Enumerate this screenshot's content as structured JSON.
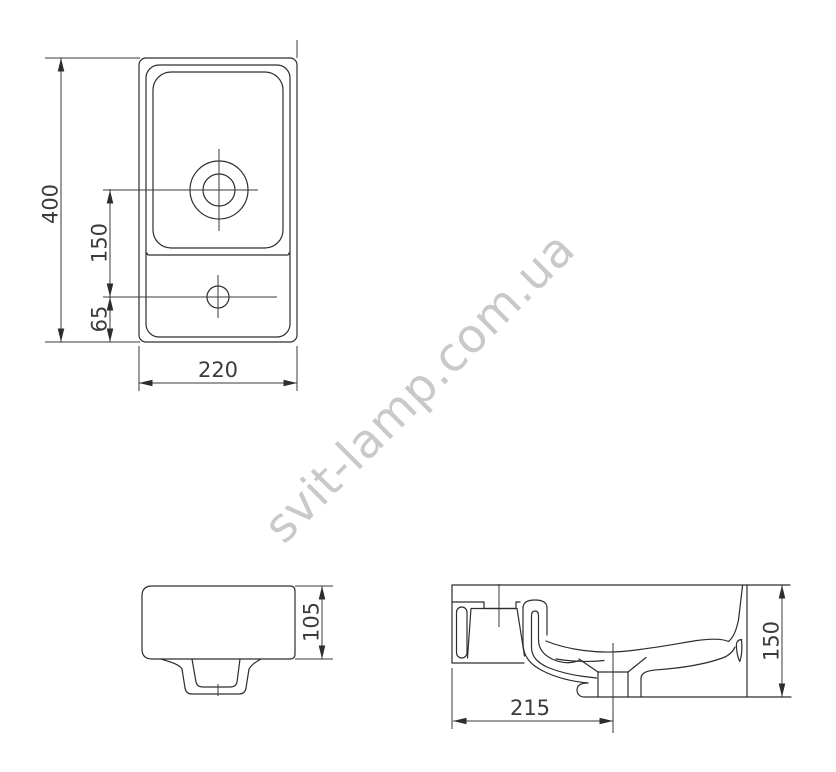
{
  "page": {
    "background": "#ffffff"
  },
  "drawing": {
    "type": "technical-drawing",
    "subject": "washbasin dimensional drawing (top view, side view, section view)",
    "watermark": "svit-lamp.com.ua",
    "colors": {
      "line": "#2d2d2d",
      "dimension_text": "#3b3b3b",
      "watermark": "#c9c9c9"
    },
    "views": {
      "top": {
        "labels": {
          "height": "400",
          "drain_to_tap": "150",
          "tap_to_bottom": "65",
          "width": "220"
        }
      },
      "side": {
        "labels": {
          "height": "105"
        }
      },
      "section": {
        "labels": {
          "drain_offset": "215",
          "height": "150"
        }
      }
    }
  }
}
